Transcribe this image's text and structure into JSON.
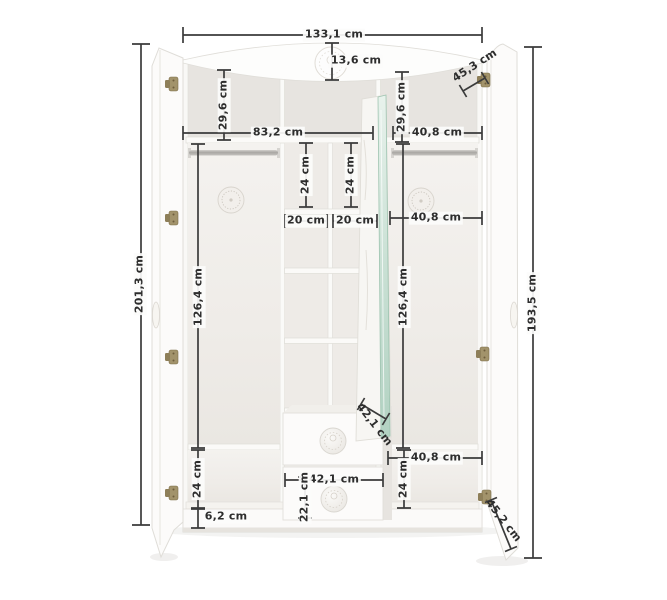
{
  "diagram": {
    "type": "product-dimension-diagram",
    "subject": "three-door wardrobe with open doors, centre cubbies, two drawers and mirror door",
    "unit": "cm",
    "colors": {
      "background": "#ffffff",
      "furniture_white": "#fbfaf8",
      "interior_shadow": "#e9e6e2",
      "dimension_line": "#3b3b3b",
      "label_text": "#2d2d2d",
      "mirror_green": "#bcd8c9",
      "hinge_brass": "#9d8e66"
    },
    "icons": {
      "hinge-icon": "brass cabinet hinge",
      "door-knob": "oval white door knob",
      "drawer-knob": "round knob with embossed crest",
      "rosette-icon": "embossed circular rosette on back panel",
      "crest-emblem-icon": "embossed crest medallion on crown rail",
      "mirror-panel": "mirror glass with green edge"
    },
    "measurements": {
      "overall_width": "133,1 cm",
      "crown_height": "13,6 cm",
      "left_top_compartment_height": "29,6 cm",
      "right_top_compartment_height": "29,6 cm",
      "right_door_top_width": "45,3 cm",
      "left_interior_width": "83,2 cm",
      "right_top_shelf_width": "40,8 cm",
      "left_cubby_height": "24 cm",
      "right_cubby_height": "24 cm",
      "left_cubby_width": "20 cm",
      "right_cubby_width": "20 cm",
      "right_interior_width": "40,8 cm",
      "overall_height": "201,3 cm",
      "left_hanging_height": "126,4 cm",
      "right_hanging_height": "126,4 cm",
      "door_height": "193,5 cm",
      "drawer_depth": "42,1 cm",
      "right_bottom_shelf_width": "40,8 cm",
      "left_bottom_compartment_height": "24 cm",
      "right_bottom_compartment_height": "24 cm",
      "drawer_width": "42,1 cm",
      "drawer_front_height": "22,1 cm",
      "plinth_height": "6,2 cm",
      "right_door_bottom_width": "45,2 cm"
    }
  }
}
